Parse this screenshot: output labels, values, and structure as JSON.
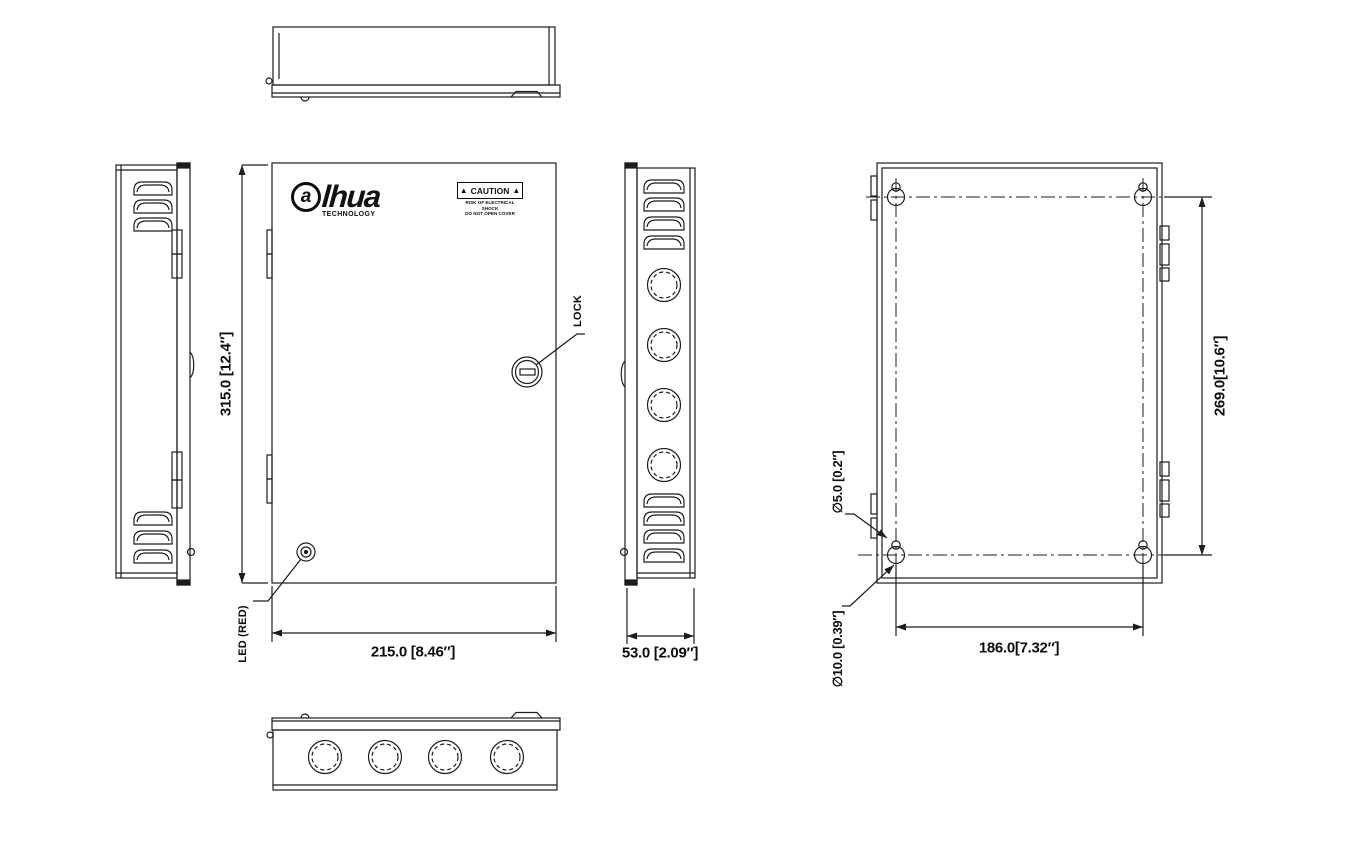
{
  "drawing": {
    "brand": {
      "logo_a": "a",
      "logo_rest": "lhua",
      "tagline": "TECHNOLOGY"
    },
    "caution": {
      "triangle": "▲",
      "title": "CAUTION",
      "line1": "RISK OF ELECTRICAL SHOCK",
      "line2": "DO NOT OPEN COVER"
    },
    "callouts": {
      "lock": "LOCK",
      "led": "LED (RED)"
    },
    "dimensions": {
      "height": "315.0 [12.4″]",
      "width": "215.0 [8.46″]",
      "depth": "53.0 [2.09″]",
      "mount_width": "186.0[7.32″]",
      "mount_height": "269.0[10.6″]",
      "hole_small": "∅5.0 [0.2″]",
      "hole_large": "∅10.0 [0.39″]"
    }
  }
}
